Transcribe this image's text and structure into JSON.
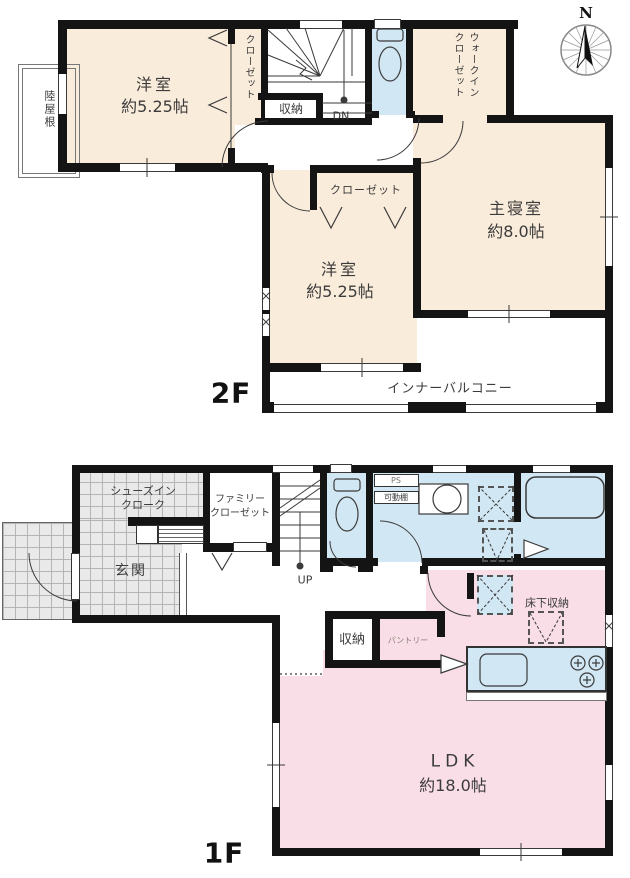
{
  "palette": {
    "room_cream": "#FAECDB",
    "wet_area_blue": "#D2E7F4",
    "ldk_pink": "#F9DEE7",
    "tile_gray": "#E9E9E9",
    "wall_black": "#141414"
  },
  "compass": {
    "north_label": "N"
  },
  "floor2": {
    "floor_label": "2F",
    "bedroom_west": {
      "name": "洋室",
      "area": "約5.25帖"
    },
    "bedroom_west_closet": "クローゼット",
    "hall_storage": "収納",
    "stairs_down": "DN",
    "walkin_closet_line1": "ウォークイン",
    "walkin_closet_line2": "クローゼット",
    "master_bedroom": {
      "name": "主寝室",
      "area": "約8.0帖"
    },
    "bedroom_south_closet": "クローゼット",
    "bedroom_south": {
      "name": "洋室",
      "area": "約5.25帖"
    },
    "inner_balcony": "インナーバルコニー",
    "flat_roof": "陸屋根"
  },
  "floor1": {
    "floor_label": "1F",
    "shoes_closet_line1": "シューズイン",
    "shoes_closet_line2": "クローク",
    "family_closet_line1": "ファミリー",
    "family_closet_line2": "クローゼット",
    "entrance": "玄関",
    "stairs_up": "UP",
    "pipe_space": "PS",
    "movable_shelf": "可動棚",
    "hall_storage": "収納",
    "pantry": "パントリー",
    "underfloor_storage": "床下収納",
    "ldk": {
      "name": "LDK",
      "area": "約18.0帖"
    }
  }
}
